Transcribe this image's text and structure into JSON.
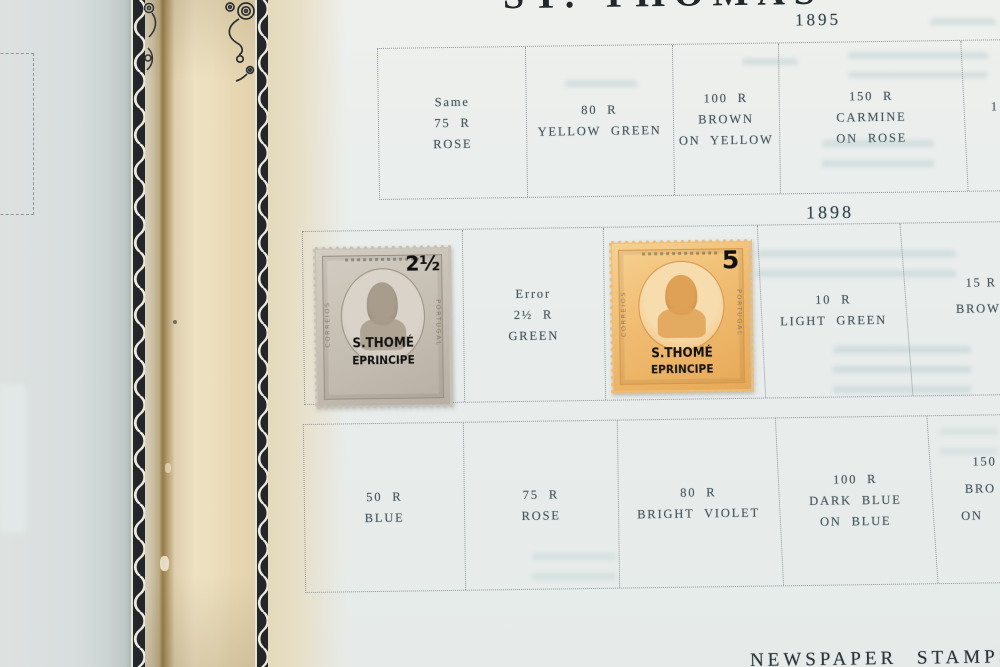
{
  "photo": {
    "title_fragment": "ST. THOMAS",
    "bottom_section_heading": "NEWSPAPER STAMPS"
  },
  "sections": [
    {
      "year": "1895",
      "cells": [
        {
          "lines": [
            "Same",
            "75 R",
            "ROSE"
          ]
        },
        {
          "lines": [
            "80 R",
            "YELLOW GREEN"
          ]
        },
        {
          "lines": [
            "100 R",
            "BROWN",
            "ON YELLOW"
          ]
        },
        {
          "lines": [
            "150 R",
            "CARMINE",
            "ON ROSE"
          ]
        },
        {
          "lines": [
            "1"
          ]
        }
      ]
    },
    {
      "year": "1898",
      "cells": [
        {
          "stamp": "gray 2½ reis stamp mounted here"
        },
        {
          "lines": [
            "Error",
            "2½ R",
            "GREEN"
          ]
        },
        {
          "stamp": "orange 5 reis stamp mounted here"
        },
        {
          "lines": [
            "10 R",
            "LIGHT GREEN"
          ]
        },
        {
          "lines": [
            "15 R",
            "BROW"
          ]
        }
      ]
    },
    {
      "year": "",
      "cells": [
        {
          "lines": [
            "50 R",
            "BLUE"
          ]
        },
        {
          "lines": [
            "75 R",
            "ROSE"
          ]
        },
        {
          "lines": [
            "80 R",
            "BRIGHT VIOLET"
          ]
        },
        {
          "lines": [
            "100 R",
            "DARK BLUE",
            "ON BLUE"
          ]
        },
        {
          "lines": [
            "150",
            "BRO",
            "ON"
          ]
        }
      ]
    }
  ],
  "stamps": [
    {
      "id": "stamp-2half-gray",
      "denomination": "2½",
      "overprint_line1": "S.THOMÉ",
      "overprint_line2": "EPRINCIPE",
      "left_inscription": "CORREIOS",
      "right_inscription": "PORTUGAL",
      "body_color": "#c7c0b5"
    },
    {
      "id": "stamp-5-orange",
      "denomination": "5",
      "overprint_line1": "S.THOMÉ",
      "overprint_line2": "EPRINCIPE",
      "left_inscription": "CORREIOS",
      "right_inscription": "PORTUGAL",
      "body_color": "#f0bc72"
    }
  ],
  "colors": {
    "page_face": "#e8eceb",
    "facing_page": "#d8dedd",
    "binding_cream": "#eee1c2",
    "crease_shadow": "#93794c",
    "print_ink": "#47575f",
    "heading_ink": "#2b353b",
    "stamp_gray": "#c7c0b5",
    "stamp_orange": "#f0bc72",
    "show_through": "#7da4aa"
  }
}
